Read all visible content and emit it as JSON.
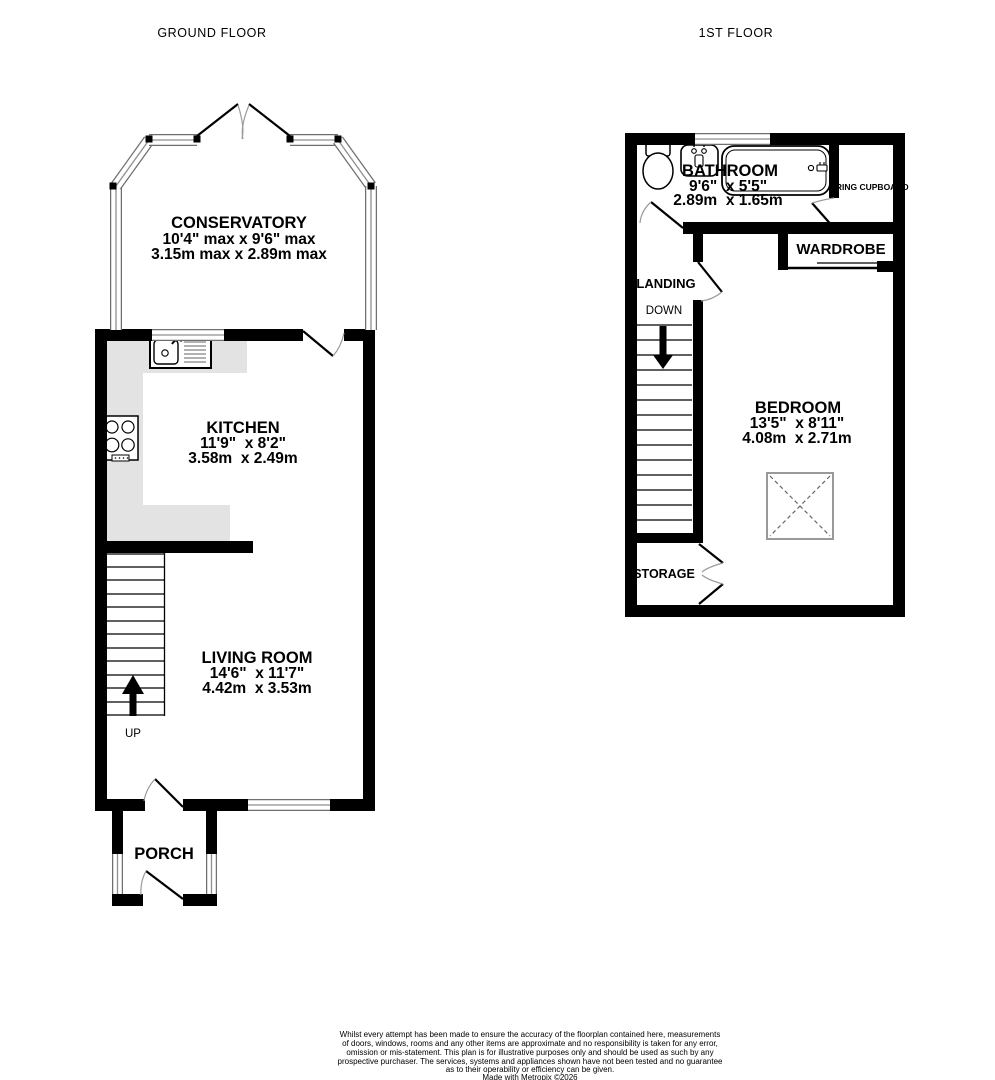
{
  "titles": {
    "ground": "GROUND FLOOR",
    "first": "1ST FLOOR"
  },
  "ground_floor": {
    "conservatory": {
      "name": "CONSERVATORY",
      "dims_imperial": "10'4\" max x 9'6\" max",
      "dims_metric": "3.15m max x 2.89m max"
    },
    "kitchen": {
      "name": "KITCHEN",
      "dims_imperial": "11'9\"  x 8'2\"",
      "dims_metric": "3.58m  x 2.49m"
    },
    "living_room": {
      "name": "LIVING ROOM",
      "dims_imperial": "14'6\"  x 11'7\"",
      "dims_metric": "4.42m  x 3.53m"
    },
    "porch": {
      "name": "PORCH"
    },
    "stairs": {
      "direction_label": "UP"
    }
  },
  "first_floor": {
    "bathroom": {
      "name": "BATHROOM",
      "dims_imperial": "9'6\"  x 5'5\"",
      "dims_metric": "2.89m  x 1.65m"
    },
    "airing_cupboard": {
      "name": "AIRING CUPBOARD"
    },
    "wardrobe": {
      "name": "WARDROBE"
    },
    "landing": {
      "name": "LANDING",
      "direction_label": "DOWN"
    },
    "bedroom": {
      "name": "BEDROOM",
      "dims_imperial": "13'5\"  x 8'11\"",
      "dims_metric": "4.08m  x 2.71m"
    },
    "storage": {
      "name": "STORAGE"
    }
  },
  "colors": {
    "wall": "#000000",
    "counter": "#e3e3e3",
    "window_line": "#8f8f8f",
    "swing_arc": "#9a9a9a"
  },
  "footer": {
    "lines": [
      "Whilst every attempt has been made to ensure the accuracy of the floorplan contained here, measurements",
      "of doors, windows, rooms and any other items are approximate and no responsibility is taken for any error,",
      "omission or mis-statement. This plan is for illustrative purposes only and should be used as such by any",
      "prospective purchaser. The services, systems and appliances shown have not been tested and no guarantee",
      "as to their operability or efficiency can be given.",
      "Made with Metropix ©2026"
    ]
  }
}
